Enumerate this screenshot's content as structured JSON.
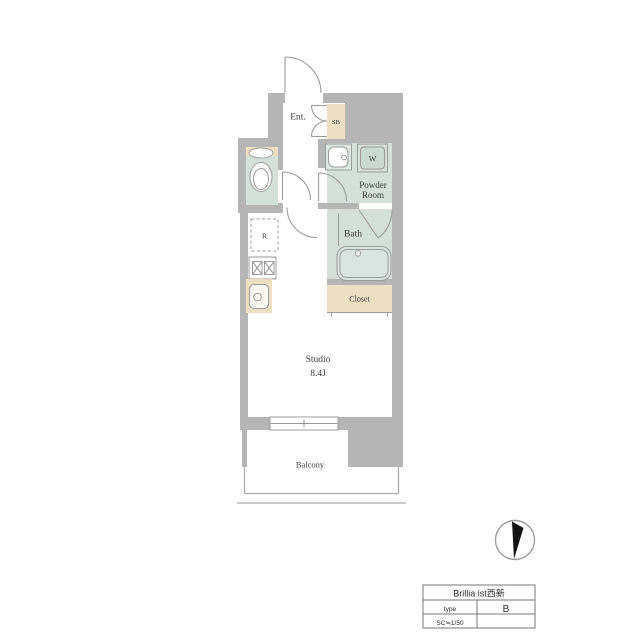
{
  "plan": {
    "labels": {
      "entrance": "Ent.",
      "shoe_box": "SB",
      "powder_room_line1": "Powder",
      "powder_room_line2": "Room",
      "washer": "W",
      "bath": "Bath",
      "refrigerator": "R",
      "closet": "Closet",
      "studio_name": "Studio",
      "studio_size": "8.4J",
      "balcony": "Balcony"
    }
  },
  "title_block": {
    "project_name": "Brillia ist西新",
    "type_label": "type",
    "type_value": "B",
    "scale": "SC≒1/50"
  },
  "colors": {
    "wall": "#b4b5b4",
    "room": "#d4e1db",
    "fixture": "#c9dad3",
    "beige": "#ecdfc2",
    "line": "#9b9b9b",
    "text": "#3a3a3a",
    "needle": "#141414"
  }
}
